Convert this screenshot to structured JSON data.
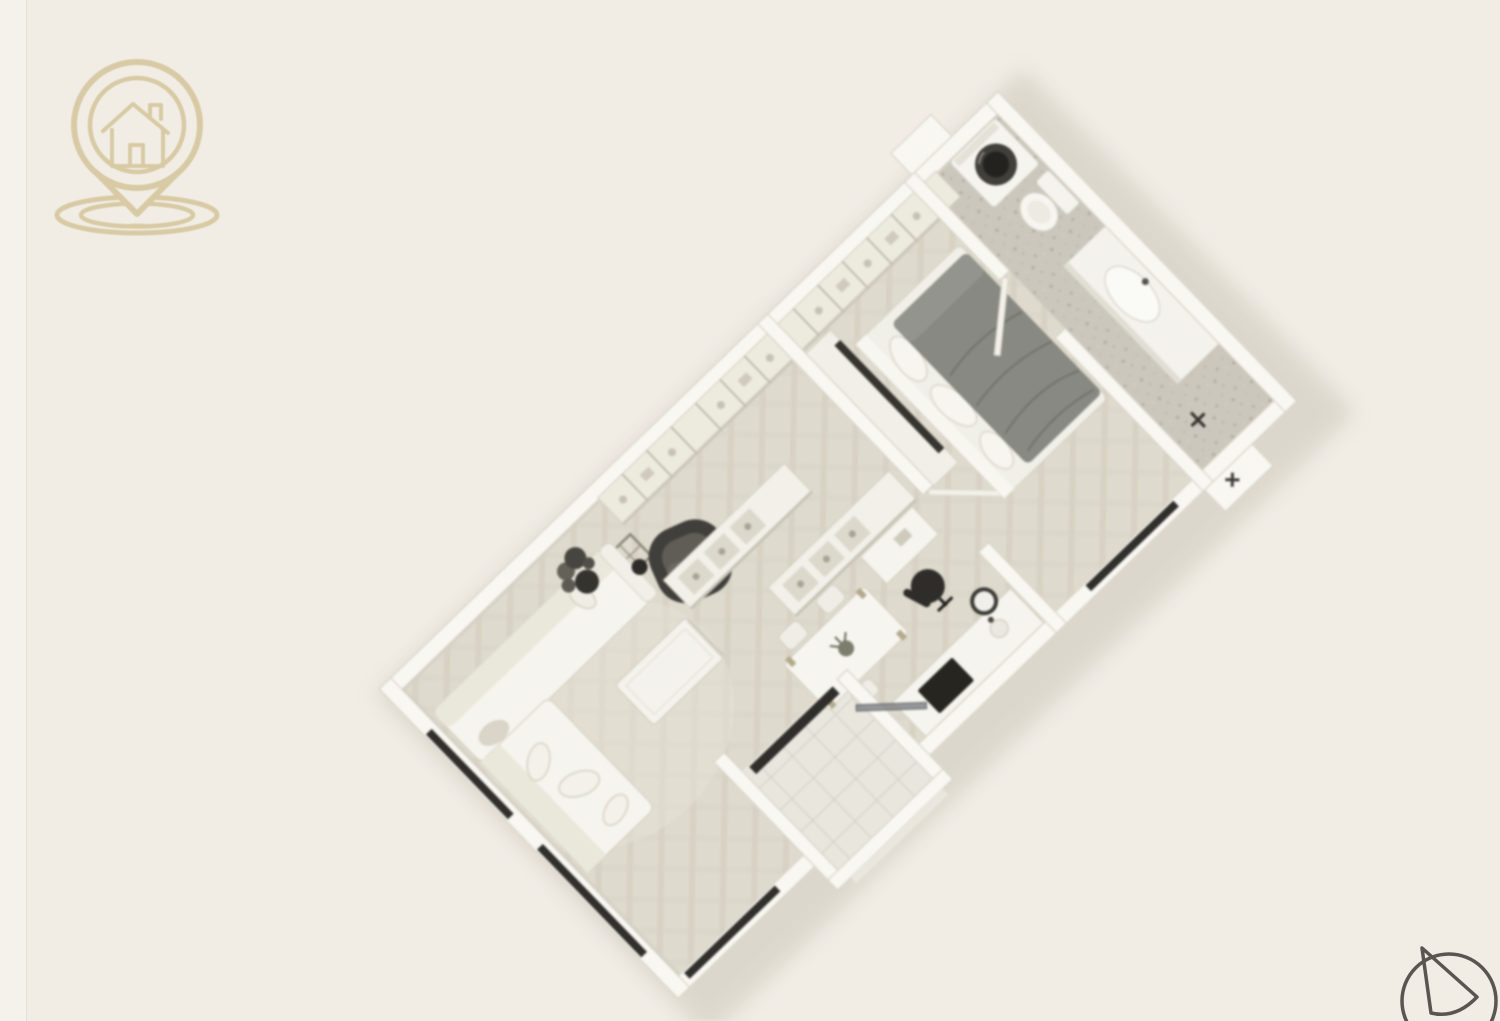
{
  "page": {
    "title": "3D isometric apartment floor plan render"
  },
  "colors": {
    "background": "#f1ede5",
    "page_edge": "#f5f1eb",
    "logo": "#d7c9a1",
    "compass": "#5a554e",
    "wall": "#f8f7f2",
    "floor_parquet": "#dedacd",
    "floor_bathroom": "#cbc7bd",
    "floor_tile": "#e9e6de",
    "duvet": "#878982",
    "dark_furniture": "#403f3b",
    "window": "#302f2b"
  },
  "logo": {
    "icon": "house-location-pin-icon"
  },
  "compass": {
    "icon": "north-arrow-icon"
  },
  "floorplan": {
    "type": "3d-isometric-apartment",
    "rotation_deg": -44,
    "rooms": [
      {
        "name": "living-room",
        "furniture": [
          "corner-sofa",
          "throw-pillows",
          "coffee-table",
          "dark-armchair",
          "potted-plant",
          "floor-vase",
          "windows"
        ]
      },
      {
        "name": "kitchen-dining",
        "furniture": [
          "kitchen-counter",
          "cooktop",
          "sink",
          "open-shelf-island-a",
          "open-shelf-island-b",
          "dining-table",
          "dining-chairs",
          "table-plant"
        ]
      },
      {
        "name": "entry-vestibule",
        "furniture": [
          "glass-entry-door",
          "doormat",
          "tiled-floor"
        ]
      },
      {
        "name": "hallway-nook",
        "furniture": [
          "wardrobe-row",
          "desk",
          "office-chair",
          "round-side-table"
        ]
      },
      {
        "name": "bedroom",
        "furniture": [
          "double-bed",
          "headboard",
          "pillows",
          "gray-duvet",
          "tv-wall-unit",
          "tv-panel",
          "windows"
        ]
      },
      {
        "name": "bathroom",
        "furniture": [
          "washing-machine",
          "toilet",
          "vanity-with-oval-sink",
          "bathroom-door",
          "towel-stand"
        ]
      }
    ]
  }
}
